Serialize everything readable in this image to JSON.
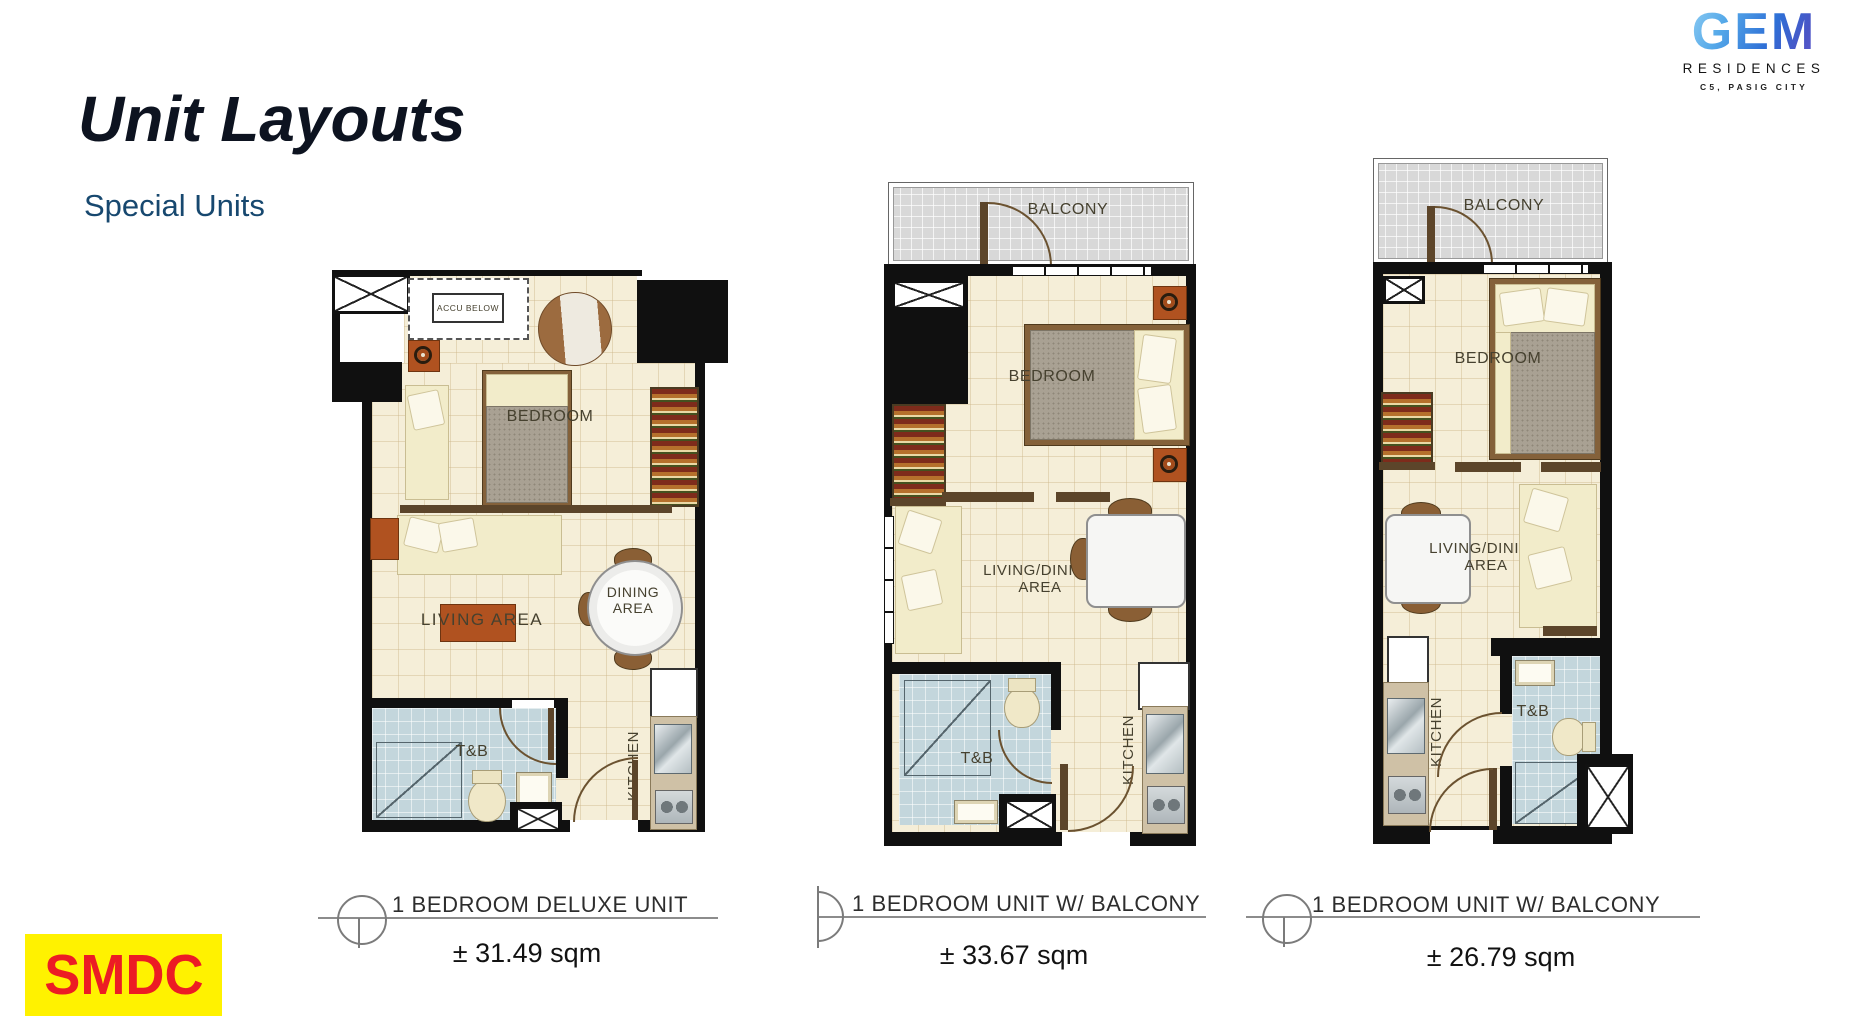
{
  "slide": {
    "title": "Unit Layouts",
    "subtitle": "Special Units"
  },
  "branding": {
    "gem_name": "GEM",
    "gem_sub": "RESIDENCES",
    "gem_city": "C5, PASIG CITY",
    "smdc": "SMDC"
  },
  "plans": [
    {
      "caption": "1 BEDROOM DELUXE UNIT",
      "area": "± 31.49 sqm",
      "labels": {
        "accu": "ACCU BELOW",
        "bedroom": "BEDROOM",
        "living": "LIVING AREA",
        "dining": "DINING AREA",
        "tnb": "T&B",
        "kitchen": "KITCHEN"
      }
    },
    {
      "caption": "1 BEDROOM UNIT W/ BALCONY",
      "area": "± 33.67 sqm",
      "labels": {
        "balcony": "BALCONY",
        "bedroom": "BEDROOM",
        "livingdining": "LIVING/DINING AREA",
        "tnb": "T&B",
        "kitchen": "KITCHEN"
      }
    },
    {
      "caption": "1 BEDROOM UNIT W/ BALCONY",
      "area": "± 26.79 sqm",
      "labels": {
        "balcony": "BALCONY",
        "bedroom": "BEDROOM",
        "livingdining": "LIVING/DINING AREA",
        "tnb": "T&B",
        "kitchen": "KITCHEN"
      }
    }
  ],
  "palette": {
    "title_color": "#0d1320",
    "subtitle_blue": "#17486f",
    "smdc_red": "#ec1c24",
    "smdc_yellow": "#fff200",
    "floor_cream": "#f5eed8",
    "tnb_blue": "#c3d6dc",
    "balcony_gray": "#d8d8d8",
    "wall_black": "#101010"
  }
}
